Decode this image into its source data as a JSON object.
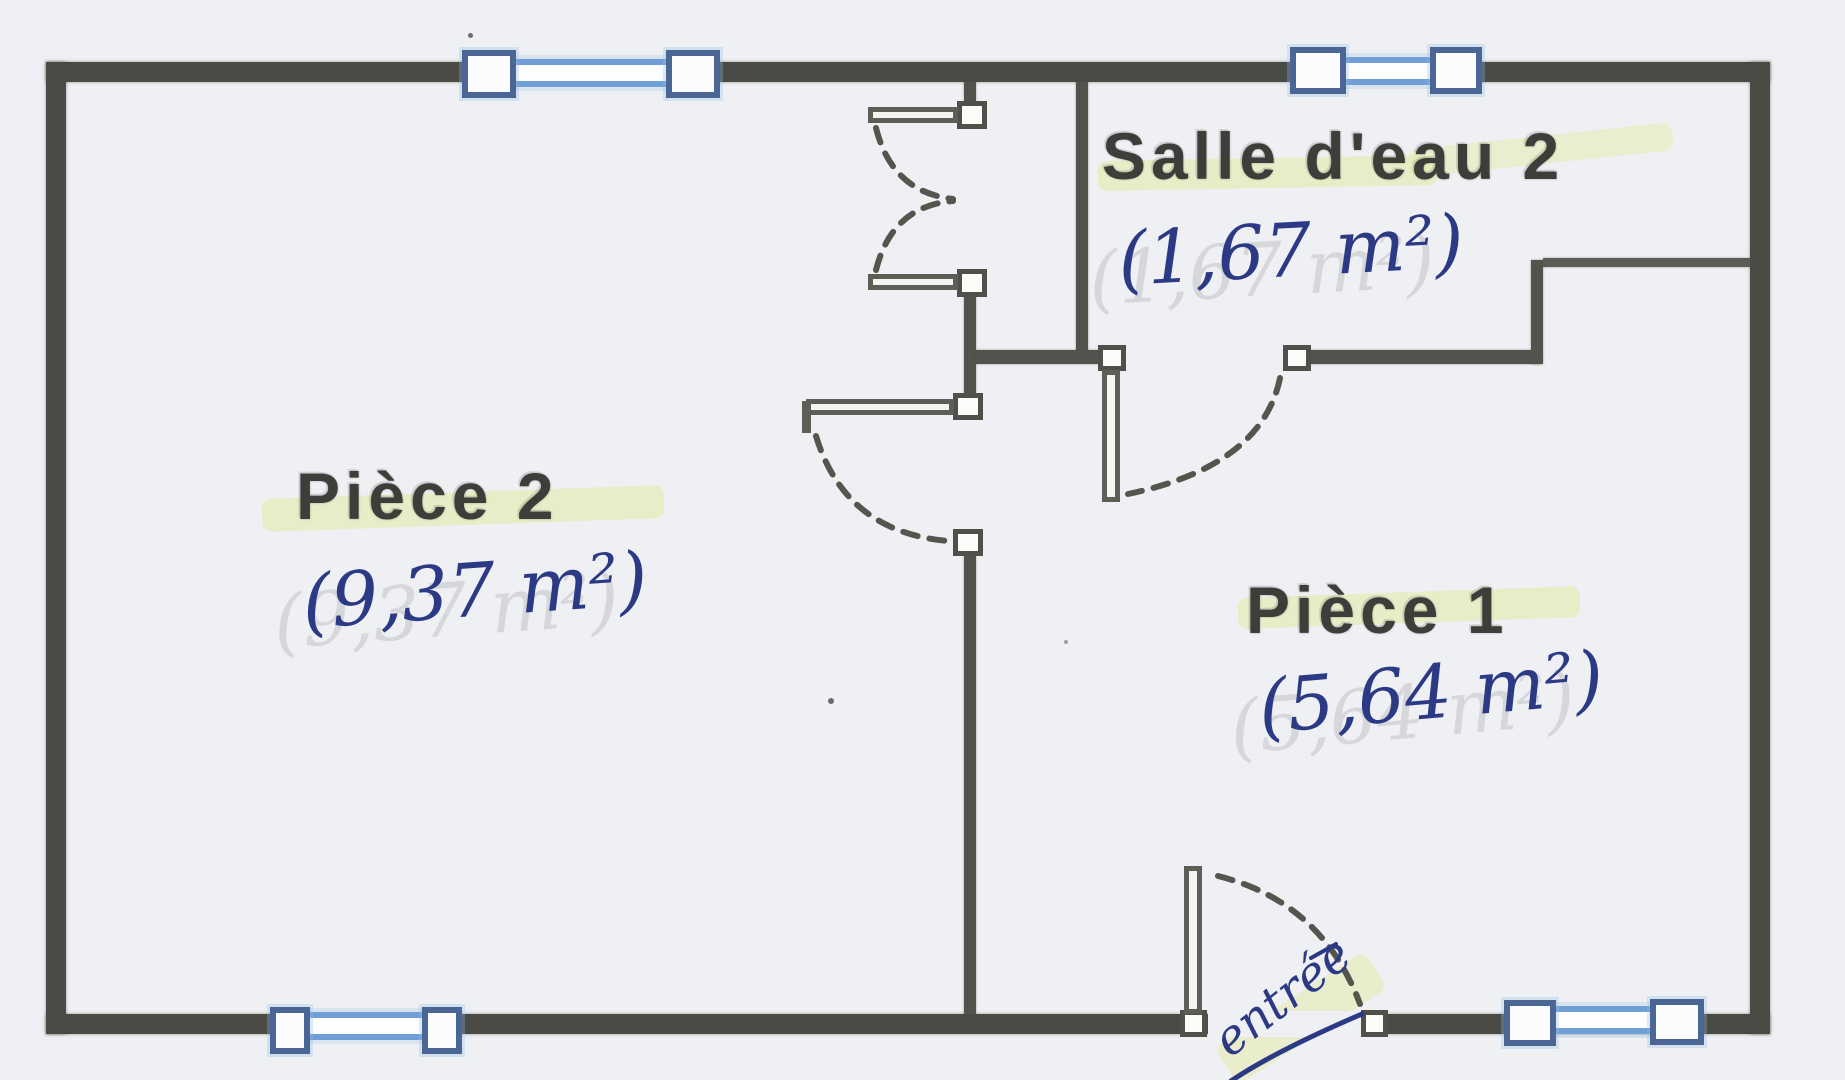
{
  "rooms": [
    {
      "id": "piece-2",
      "label": "Pièce 2",
      "area": "(9,37 m²)"
    },
    {
      "id": "piece-1",
      "label": "Pièce 1",
      "area": "(5,64 m²)"
    },
    {
      "id": "salle-d-eau-2",
      "label": "Salle d'eau 2",
      "area": "(1,67 m²)"
    }
  ],
  "annotations": {
    "entry_label": "entrée"
  },
  "symbols": {
    "windows": [
      "window-top-left",
      "window-top-right",
      "window-bottom-left",
      "window-bottom-right"
    ],
    "doors": [
      "closet-double-door",
      "piece2-piece1-doorway",
      "salle-d-eau-door",
      "entry-door"
    ]
  },
  "colors": {
    "paper": "#eef0f3",
    "wall": "#4b4b46",
    "window_blue": "#6f9fd6",
    "window_frame": "#4a6695",
    "ink_blue": "#2c3a85",
    "highlighter": "#e5ebab",
    "label_text": "#3d3d39"
  }
}
